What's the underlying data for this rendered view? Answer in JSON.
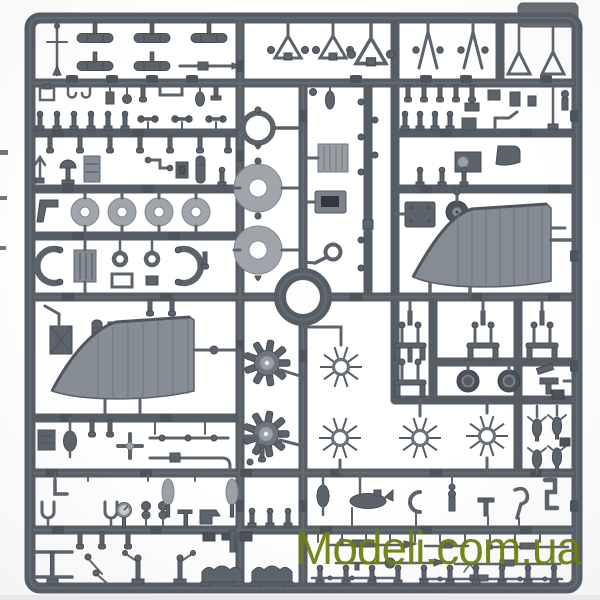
{
  "scene": {
    "subject": "Dark gray injection-molded plastic model kit sprue with unassembled parts, photographed on a white background",
    "plastic_color": "#5c636b",
    "plastic_light_color": "#9aa0a7",
    "background_color": "#ffffff",
    "notable_parts": [
      "wing panels",
      "radial engine discs",
      "spoked spider rings",
      "cowl rings",
      "donut wheels",
      "small bombs",
      "triangular struts",
      "machine guns",
      "cockpit details"
    ]
  },
  "watermark": {
    "text": "Modeli.com.ua",
    "color": "#6f7f10"
  }
}
